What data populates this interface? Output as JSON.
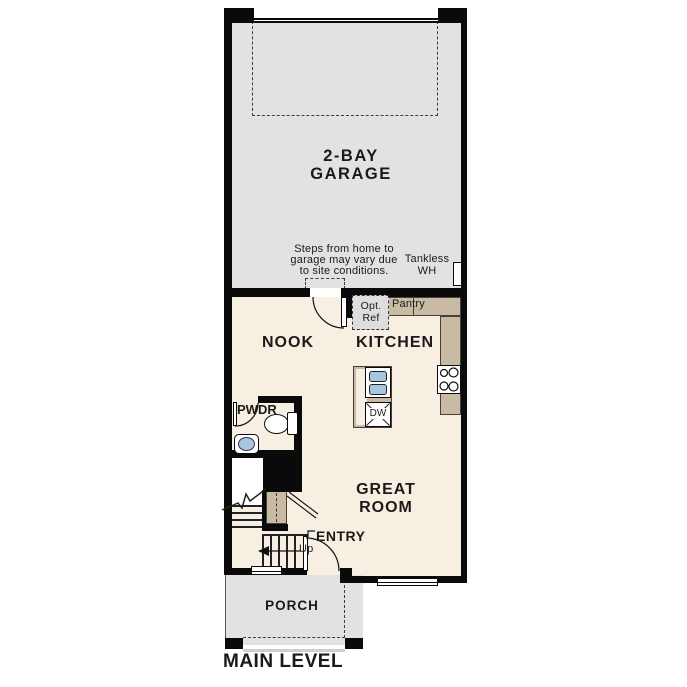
{
  "title": {
    "main_level": "MAIN LEVEL"
  },
  "colors": {
    "wall": "#0a0a0a",
    "garage_floor": "#e2e2e2",
    "house_floor": "#f7efe2",
    "porch_floor": "#e2e2e2",
    "counter_tan": "#c9bba3",
    "fixture_blue": "#a9c6e1",
    "optref_gray": "#dedede",
    "text": "#1a1a1a"
  },
  "garage": {
    "name_1": "2-BAY",
    "name_2": "GARAGE",
    "steps_note_1": "Steps from home to",
    "steps_note_2": "garage may vary due",
    "steps_note_3": "to site conditions.",
    "tankless_1": "Tankless",
    "tankless_2": "WH"
  },
  "kitchen": {
    "name": "KITCHEN",
    "pantry": "Pantry",
    "opt_ref_1": "Opt.",
    "opt_ref_2": "Ref",
    "dishwasher": "DW"
  },
  "rooms": {
    "nook": "NOOK",
    "great_room_1": "GREAT",
    "great_room_2": "ROOM",
    "powder": "PWDR",
    "entry": "ENTRY",
    "porch": "PORCH"
  },
  "stairs": {
    "up": "Up"
  }
}
